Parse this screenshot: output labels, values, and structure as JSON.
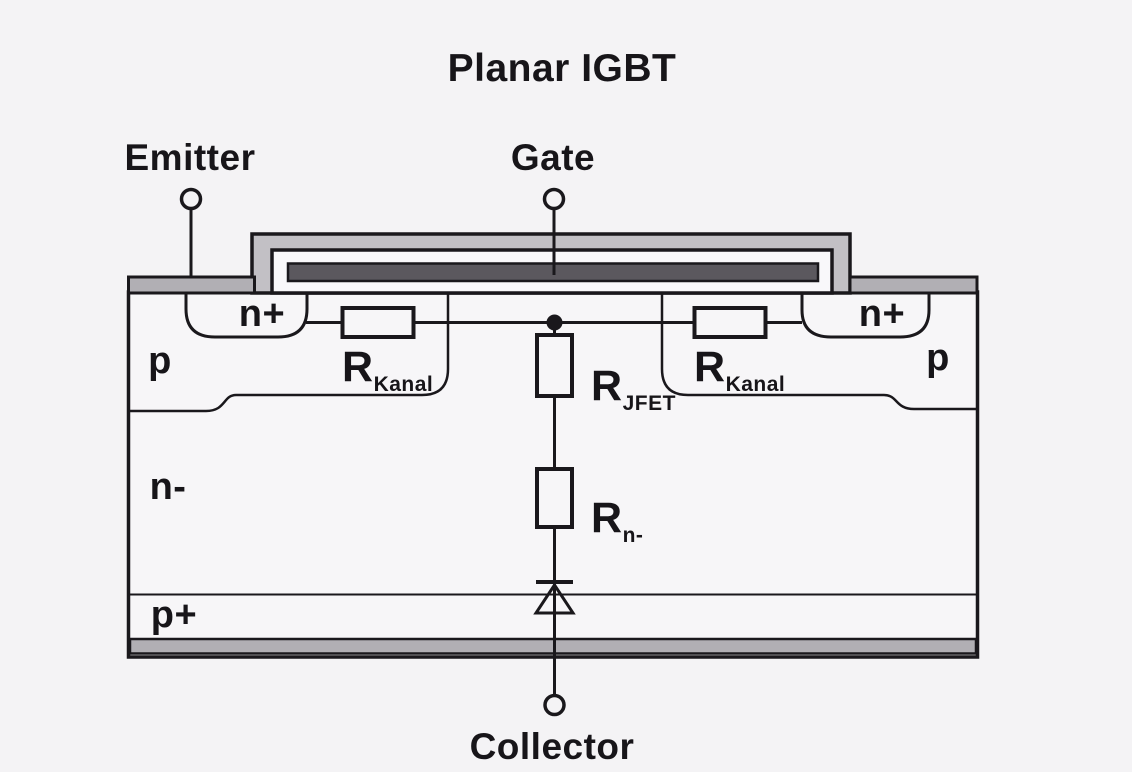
{
  "title": "Planar IGBT",
  "terminals": {
    "emitter": "Emitter",
    "gate": "Gate",
    "collector": "Collector"
  },
  "regions": {
    "n_plus_left": "n+",
    "n_plus_right": "n+",
    "p_left": "p",
    "p_right": "p",
    "n_drift": "n-",
    "p_plus": "p+"
  },
  "resistors": {
    "kanal_left": {
      "base": "R",
      "sub": "Kanal"
    },
    "kanal_right": {
      "base": "R",
      "sub": "Kanal"
    },
    "jfet": {
      "base": "R",
      "sub": "JFET"
    },
    "n_drift": {
      "base": "R",
      "sub": "n-"
    }
  },
  "colors": {
    "background": "#f4f3f5",
    "silicon": "#f7f6f8",
    "metal": "#b1afb4",
    "gate_stack_outer": "#c2c0c5",
    "gate_oxide": "#f9f8fa",
    "gate_electrode": "#5b585e",
    "line": "#1a181c"
  }
}
